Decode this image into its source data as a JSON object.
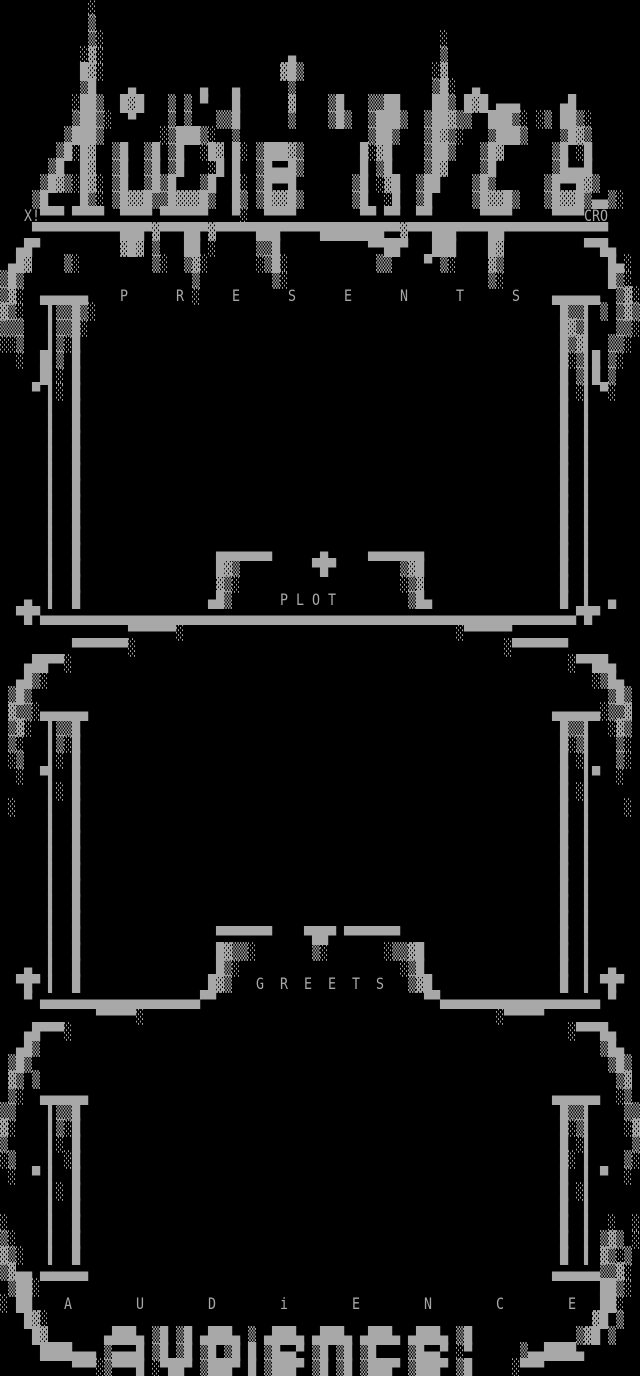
{
  "art": {
    "columns": 80,
    "visible_rows": 86,
    "background_color": "#000000",
    "foreground_color": "#a8a8a8",
    "rows": [
      "           ░                                                                    ",
      "           ▒                                                                    ",
      "           ▒░                                          ░                        ",
      "          ░▓░                       ▄                  ▒                        ",
      "          █▓░                      ▓█▒                ░▓                        ",
      "          ▒█    ▄        ▄   ▄      ▒                 ▒█░  ▄                    ",
      "         ░██▒  █▓█   ▒ ▒ ▀   █      ▓    ▒█   ▒▒██    ██▒ █▓█ ▄▄▄     ▄█        ",
      "         ▒██▒░  ▀    ▒ ▒   ▒▒█      ▒    ▒█▒  ▒███▒  ▒██▓▒▒  ███▒░ ░▒ ██▒░      ",
      "        ▒███▒       ░▒███▒░  ▒                ▒██▒   ▒█▓▒░   ▒███▒    ▒█▓▒      ",
      "       ▒█░█▓  ▒█  ▒█ ▒█  ░█▓ █░ ▒███▓▒       █░▓█    ▒██▒   ▒█▓      ▒█ ░█      ",
      "      ▒█  █▓  ▒█  ▒█ ▒█   ░█ █  ▒█▄▄█▒       █ ▒█    ▒█▓    ▒█       ▒█▄▄█      ",
      "     ▒█▓▒░█▓░ ▒█  ▒█▒█   ▒█  █░ ▒█▀▀█       ▒█ ░▓█  ▒██    ▒█▒      ▒█▀▀█▓▒     ",
      "    ▒█    █▒░ ▒█▓▓█▒▒█▓▓▓█▒  █▒ ▒█▓▓█▒      ▒█  ░█  ▒█     ▒█▓▓█▒   ▒█▓▓█▒▄▄▒░  ",
      "   X!▀▀▀ ▀▀▀▀  ▀▀▀▀ ▀▀▀▀▀▀   ▀░  ▀▀▀▀        ▀▀ ▀▀  ▀▀      ▀▀▀▀     ▀▀▀▀CRO    ",
      "    ▀▀▀▀▀▀▀▀▀▀▀███▀▓▀▀▀██▀▓▀▀▀▀▀███▀▀▀▀▀████████▀▀▓▀▀▀███▀▀▀▀██▀▀▀▀▀▀▀▀▀▀▀▀▀    ",
      "  ▄█▀          ▓█▓ ▒   ██ ░     ▒▒█           ▀▀██▀   ███    █▓          ▀▀█▄   ",
      " ▄█▓    ▒░         ▒░  ▒▓░      ░▒█░           ▒▒    ▀ ▒░    ▓▒             █▄░ ",
      "▒█▒                     ▒         ▒░                         ▒░             █▒░ ",
      "▒▓░  ▄▄▄▄▄▄    P      R ░    E      S      E      N      T      S    ▄▄▄▄▄▄  ▒▓░",
      "▓▒░   ▌▒▒█▒░                                                          █▒▒▌ ▒ ▒▓▒",
      "▒▒▒   ▌▒▒█░                                                           █▓▒▌   ▒▒░",
      "░░▒   ▌▒░█                                                            █▒▓▌  ▒▒░ ",
      "  ░  █▌▒ █                                                            █░▒▌█ ▒░  ",
      "     █▌░ █                                                            █ ▒▌█ ▒   ",
      "    ▀ ▌░ █                                                            █ ░▌ ▀░   ",
      "      ▌  █                                                            █  ▌      ",
      "      ▌  █                                                            █  ▌      ",
      "      ▌  █                                                            █  ▌      ",
      "      ▌  █                                                            █  ▌      ",
      "      ▌  █                                                            █  ▌      ",
      "      ▌  █                                                            █  ▌      ",
      "      ▌  █                                                            █  ▌      ",
      "      ▌  █                                                            █  ▌      ",
      "      ▌  █                                                            █  ▌      ",
      "      ▌  █                 ▄▄▄▄▄▄▄      ▄     ▄▄▄▄▄▄▄                 █  ▌      ",
      "      ▌  █                 █▓▒         ▀█▀        ▒▓█                 █  ▌      ",
      "      ▌  █                 ▓▒░                    ░▒▓                 █  ▌      ",
      "   ▄  ▌  █                ▄█▒      P L O T         ▒█▄                █  ▌  ▄   ",
      "  ▀█▀▄▄▄▄▄▄▄▄▄▄▄▄▄▄▄▄▄▄▄▄▄▄▄▄▄▄▄▄▄▄▄▄▄▄▄▄▄▄▄▄▄▄▄▄▄▄▄▄▄▄▄▄▄▄▄▄▄▄▄▄▄▄▄▄▄▄▄▀█▀  ",
      "                ▀▀▀▀▀▀░                                  ░▀▀▀▀▀▀                ",
      "         ▀▀▀▀▀▀▀░                                              ░▀▀▀▀▀▀▀         ",
      "   ▄██▀▀░                                                              ░▀▀██▄   ",
      "  ▄█▒░                                                                    ░▒█▄  ",
      " ▒█▒                                                                        ▒█▒ ",
      " ▓▒▒░▄▄▄▄▄▄                                                          ▄▄▄▄▄▄░▒▒▓ ",
      " ▒▓░  ▌▒▒█                                                            █▒▒▌  ░▓▒ ",
      " ▒░   ▌▒░█                                                            █░▒▌   ▒░ ",
      " ░▒   ▌░ █                                                            █ ░▌   ▒░ ",
      "  ░  ▀▌  █                                                            █  ▌▀  ░  ",
      "      ▌░ █                                                            █ ░▌      ",
      " ░    ▌  █                                                            █  ▌    ░ ",
      "      ▌  █                                                            █  ▌      ",
      "      ▌  █                                                            █  ▌      ",
      "      ▌  █                                                            █  ▌      ",
      "      ▌  █                                                            █  ▌      ",
      "      ▌  █                                                            █  ▌      ",
      "      ▌  █                                                            █  ▌      ",
      "      ▌  █                                                            █  ▌      ",
      "      ▌  █                 ▀▀▀▀▀▀▀    ▀██▀ ▀▀▀▀▀▀▀                    █  ▌      ",
      "      ▌  █                 █▓▒▒░       ▒░       ░▒▒▓█                 █  ▌      ",
      "   ▄  ▌  █                 █▒░                    ░▒█                 █  ▌  ▄   ",
      "  ▀█▀ ▌  █                █▓▒   G  R  E  E  T  S   ▒▓█                █  ▌ ▀█▀  ",
      "   ▀ ▄▄▄▄▄▄▄▄▄▄▄▄▄▄▄▄▄▄▄▄▀▀                          ▀▀▄▄▄▄▄▄▄▄▄▄▄▄▄▄▄▄▄▄▄▄ ▀   ",
      "            ▀▀▀▀▀░                                            ░▀▀▀▀▀            ",
      "   ▄█▀▀▀░                                                              ░▀▀▀█▄   ",
      "  ▄█▒                                                                      ▒█▄  ",
      " ▒█▒                                                                        ▒█▒ ",
      " ▓▒ ▒                                                                        ▒▓ ",
      " ▒░  ▄▄▄▄▄▄                                                          ▄▄▄▄▄▄  ░▒ ",
      "▒▒    ▌▒▒█                                                            █▒▒▌    ▒▒",
      "▓░    ▌▒░█                                                            █░▒▌    ░▓",
      "▒     ▌░ █                                                            █ ░▌     ▒",
      "░▒    ▌ ░█                                                            █░ ▌    ▒░",
      " ░  ▀ ▌  █                                                            █  ▌ ▀  ░ ",
      "      ▌░ █                                                            █ ░▌      ",
      "      ▌  █                                                            █  ▌      ",
      "░     ▌  █                                                            █  ▌  ░  ░",
      "▒░    ▌  █                                                            █  ▌ ▒▓▒ ░",
      "▓▒░   ▌  █                                                            █  ▌ ▓▒░▒ ",
      "▒▓▄▄ ▄▄▄▄▄▄                                                          ▄▄▄▄▄▄▒▒▓░ ",
      " ▒██░                                                                      ██▒░ ",
      "░ ██    A        U        D        i        E        N        C        E   ██░  ",
      "   █▓░                                                                    ▓█ ▒  ",
      "    █▓       ▄███▄ ▒█ ▒█ ▄███▄ ▒ ▄███▄ ▄███▄ ▄███▄ ▄███▄ ▒█             ▒▓█ ▒   ",
      "     ████▄▄▄ ▒▄▄▄█ ▒█ ▒█ ▒█ ▒█ █ ▒█▄▄▀ ▒█ ▒█ ▒█    ▒█▄▄▀ ░▀      ▒▄▄████▄       ",
      "         ▀▀▀░▒▀▀▀█ ░▀██▀ ▒███▀ █ ▒███▀ ▒█ ▒█ ▒███▀ ▒███▀ ▒█     ░▀▀▀            "
    ]
  },
  "texts": {
    "logo": "Audience",
    "credit_left": "X!",
    "credit_right": "CRO",
    "section_presents": "P R E S E N T S",
    "section_plot": "P L O T",
    "section_greets": "G  R  E  E  T  S",
    "section_audience": "A U D i E N C E",
    "footer_big_text": "audience!"
  }
}
